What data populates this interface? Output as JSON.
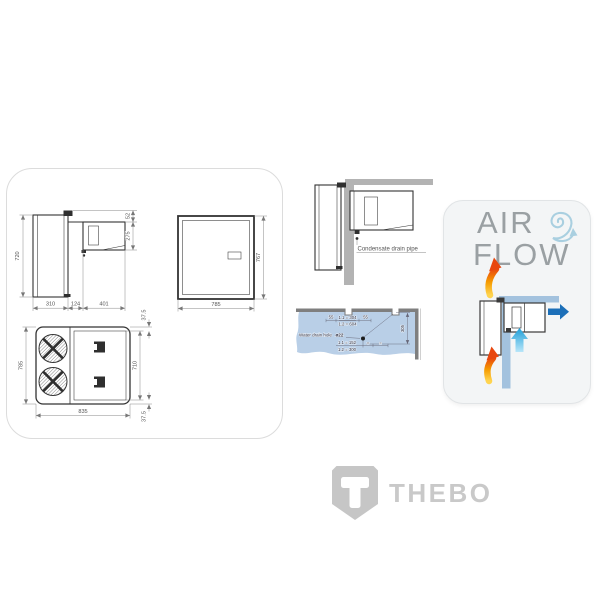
{
  "drawings_panel": {
    "side_view": {
      "height": "720",
      "depth_inner": "310",
      "wall_thickness": "124",
      "depth_outer": "401",
      "bracket_offset": "52",
      "unit_height": "275"
    },
    "front_view": {
      "width": "785",
      "height": "767"
    },
    "top_view": {
      "depth": "785",
      "width": "835",
      "body_width": "710",
      "flange_top": "37.5",
      "flange_bottom": "37.5"
    }
  },
  "installation": {
    "condensate": {
      "label": "Condensate drain pipe"
    },
    "water_drain": {
      "label": "Water drain hole",
      "hole": "ø22",
      "offset_left": "55",
      "offset_right": "55",
      "pitch_model_1": "1.1 = 304",
      "pitch_model_2": "1.2 = 604",
      "center_model_1": "1.1 = 152",
      "center_model_2": "1.2 = 300",
      "edge_distance": "305",
      "equal_left": "=",
      "equal_right": "="
    }
  },
  "airflow": {
    "word_air": "AIR",
    "word_flow": "FLOW"
  },
  "logo": {
    "brand": "THEBO"
  },
  "colors": {
    "hot_air_gradient_start": "#ffd44f",
    "hot_air_gradient_mid": "#f59b00",
    "hot_air_gradient_end": "#e8470f",
    "cold_air": "#29a3dc",
    "outlet_air": "#1c6fb8",
    "airflow_wall_blue": "#a3c2de",
    "drawing_wall_gray": "#b3b3b3",
    "water_panel_blue": "#b9cfe7",
    "swirl_blue": "#a9cfe0",
    "title_gray": "#9aa0a3",
    "logo_gray": "#c7c7c7"
  }
}
